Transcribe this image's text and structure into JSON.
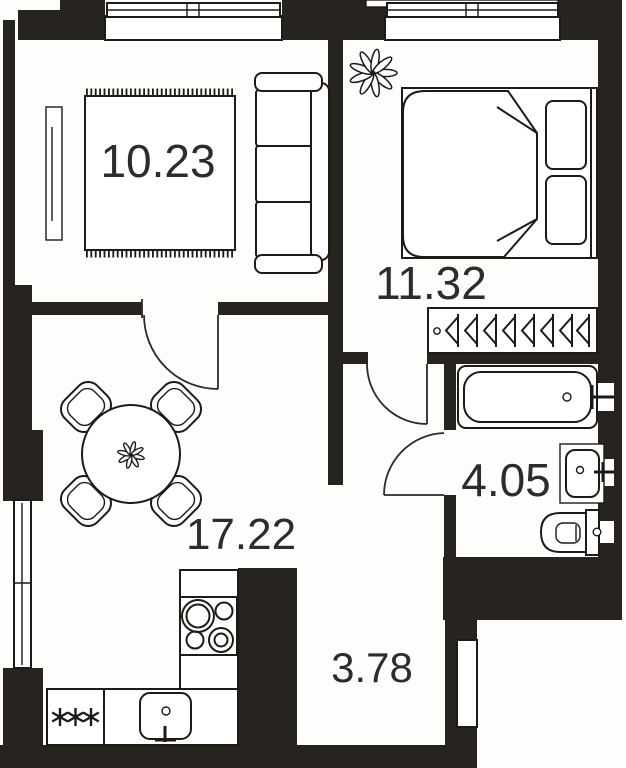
{
  "floorplan": {
    "type": "apartment-floor-plan",
    "rooms": [
      {
        "id": "room-top-left",
        "area_label": "10.23"
      },
      {
        "id": "bedroom",
        "area_label": "11.32"
      },
      {
        "id": "living-kitchen",
        "area_label": "17.22"
      },
      {
        "id": "bathroom",
        "area_label": "4.05"
      },
      {
        "id": "hallway",
        "area_label": "3.78"
      }
    ],
    "colors": {
      "wall": "#27231f",
      "line": "#1d1b18",
      "floor": "#ffffff",
      "background": "#fbfaf8"
    },
    "furniture": [
      "rug",
      "sofa",
      "radiator-cabinet",
      "double-bed",
      "pillows",
      "flower-plant",
      "wardrobe-rail-hangers",
      "bathtub",
      "washbasin",
      "toilet",
      "round-dining-table",
      "four-chairs",
      "table-flower",
      "kitchen-counter",
      "stove-four-burners",
      "kitchen-sink",
      "fridge-freezer",
      "entry-door",
      "interior-door-swings",
      "windows"
    ]
  }
}
